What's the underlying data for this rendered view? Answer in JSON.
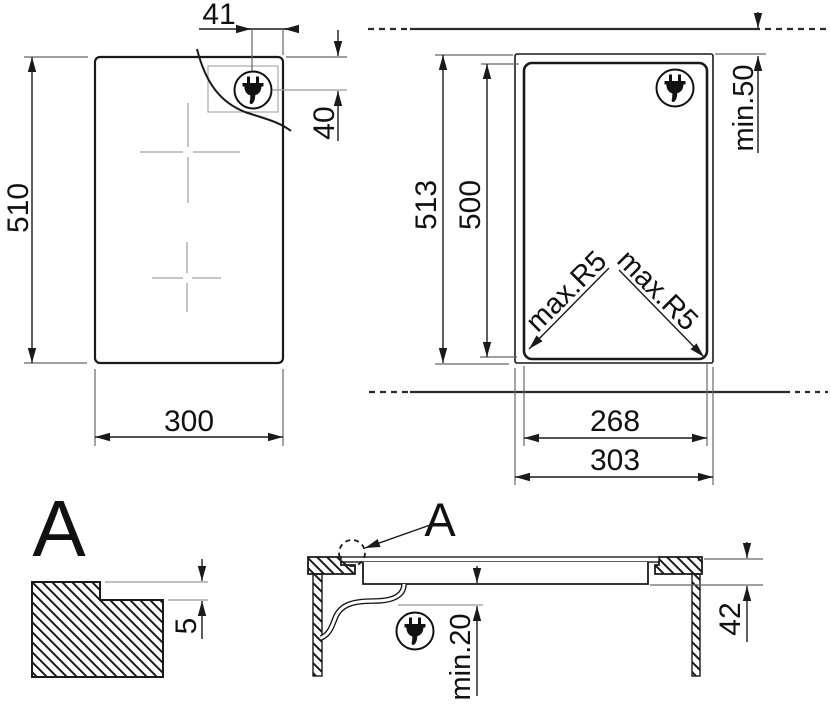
{
  "plan_view": {
    "height_label": "510",
    "width_label": "300",
    "plug_offset_right_label": "41",
    "plug_offset_top_label": "40"
  },
  "cutout_view": {
    "outer_height_label": "513",
    "cutout_height_label": "500",
    "rear_clearance_label": "min.50",
    "corner_radius_left_label": "max.R5",
    "corner_radius_right_label": "max.R5",
    "cutout_width_label": "268",
    "outer_width_label": "303"
  },
  "detail_a": {
    "title": "A",
    "step_height_label": "5"
  },
  "section_view": {
    "detail_marker_label": "A",
    "clearance_below_label": "min.20",
    "overall_height_label": "42"
  },
  "colors": {
    "line": "#1a1a1a",
    "extension": "#666666",
    "reference": "#999999",
    "zone_cross": "#c5c5c5"
  }
}
